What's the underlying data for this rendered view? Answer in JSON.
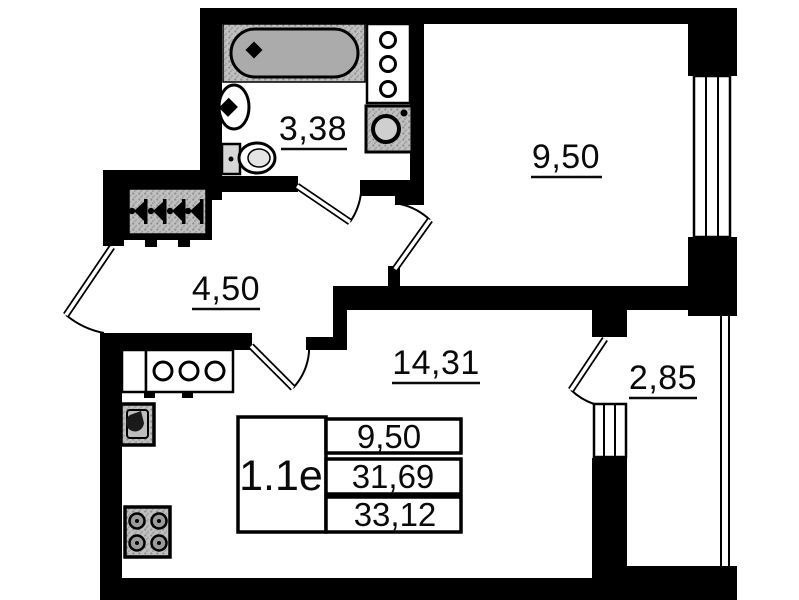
{
  "plan": {
    "rooms": {
      "bathroom": "3,38",
      "room1": "9,50",
      "hallway": "4,50",
      "kitchen_living": "14,31",
      "balcony": "2,85"
    },
    "table": {
      "unit": "1.1e",
      "rows": [
        "9,50",
        "31,69",
        "33,12"
      ]
    },
    "colors": {
      "wall": "#000000",
      "fixture_fill": "#bdbdbd",
      "background": "#ffffff"
    }
  }
}
